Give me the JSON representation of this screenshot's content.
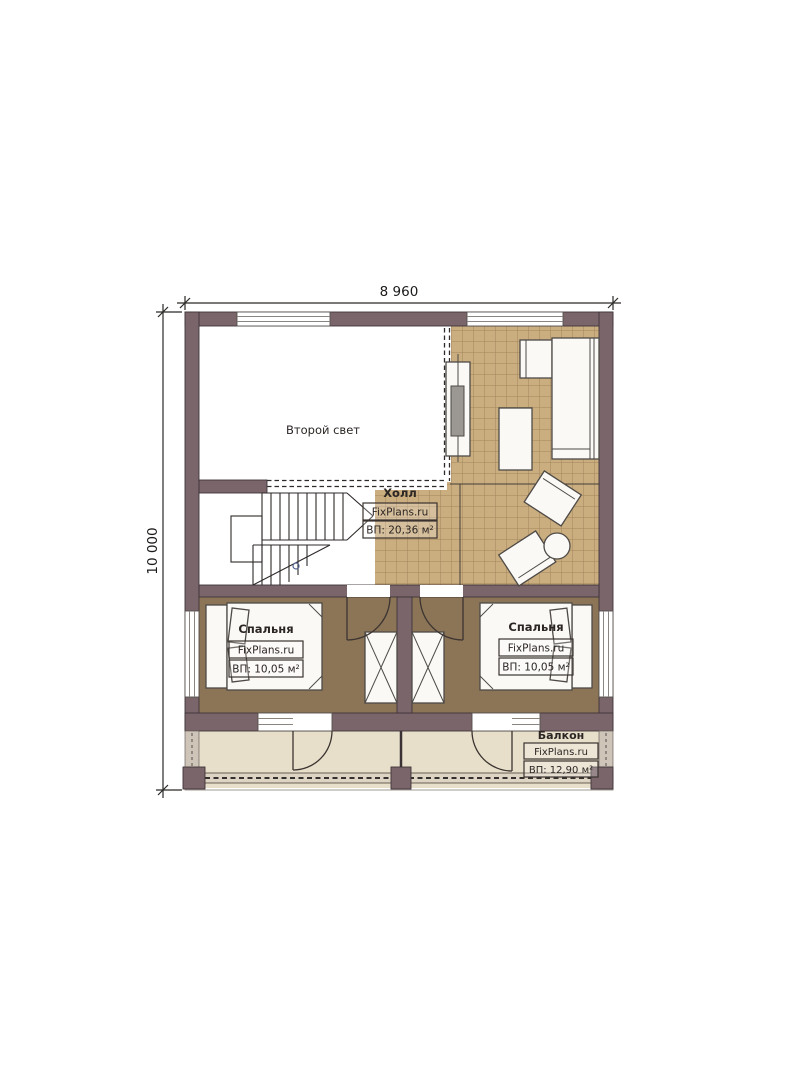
{
  "dimensions": {
    "top": "8 960",
    "left": "10 000"
  },
  "rooms": {
    "second_light": {
      "name": "Второй свет"
    },
    "hall": {
      "name": "Холл",
      "brand": "FixPlans.ru",
      "area": "ВП: 20,36 м²"
    },
    "bedroom_left": {
      "name": "Спальня",
      "brand": "FixPlans.ru",
      "area": "ВП: 10,05 м²"
    },
    "bedroom_right": {
      "name": "Спальня",
      "brand": "FixPlans.ru",
      "area": "ВП: 10,05 м²"
    },
    "balcony": {
      "name": "Балкон",
      "brand": "FixPlans.ru",
      "area": "ВП: 12,90 м²"
    }
  },
  "colors": {
    "wall": "#7a656a",
    "wall_edge": "#3f3539",
    "tile": "#cbae80",
    "bedroom_floor": "#8c7457",
    "balcony_floor": "#e8dfcb",
    "ink": "#2b2624",
    "furniture": "#faf9f6",
    "furniture_edge": "#4e4a46"
  }
}
